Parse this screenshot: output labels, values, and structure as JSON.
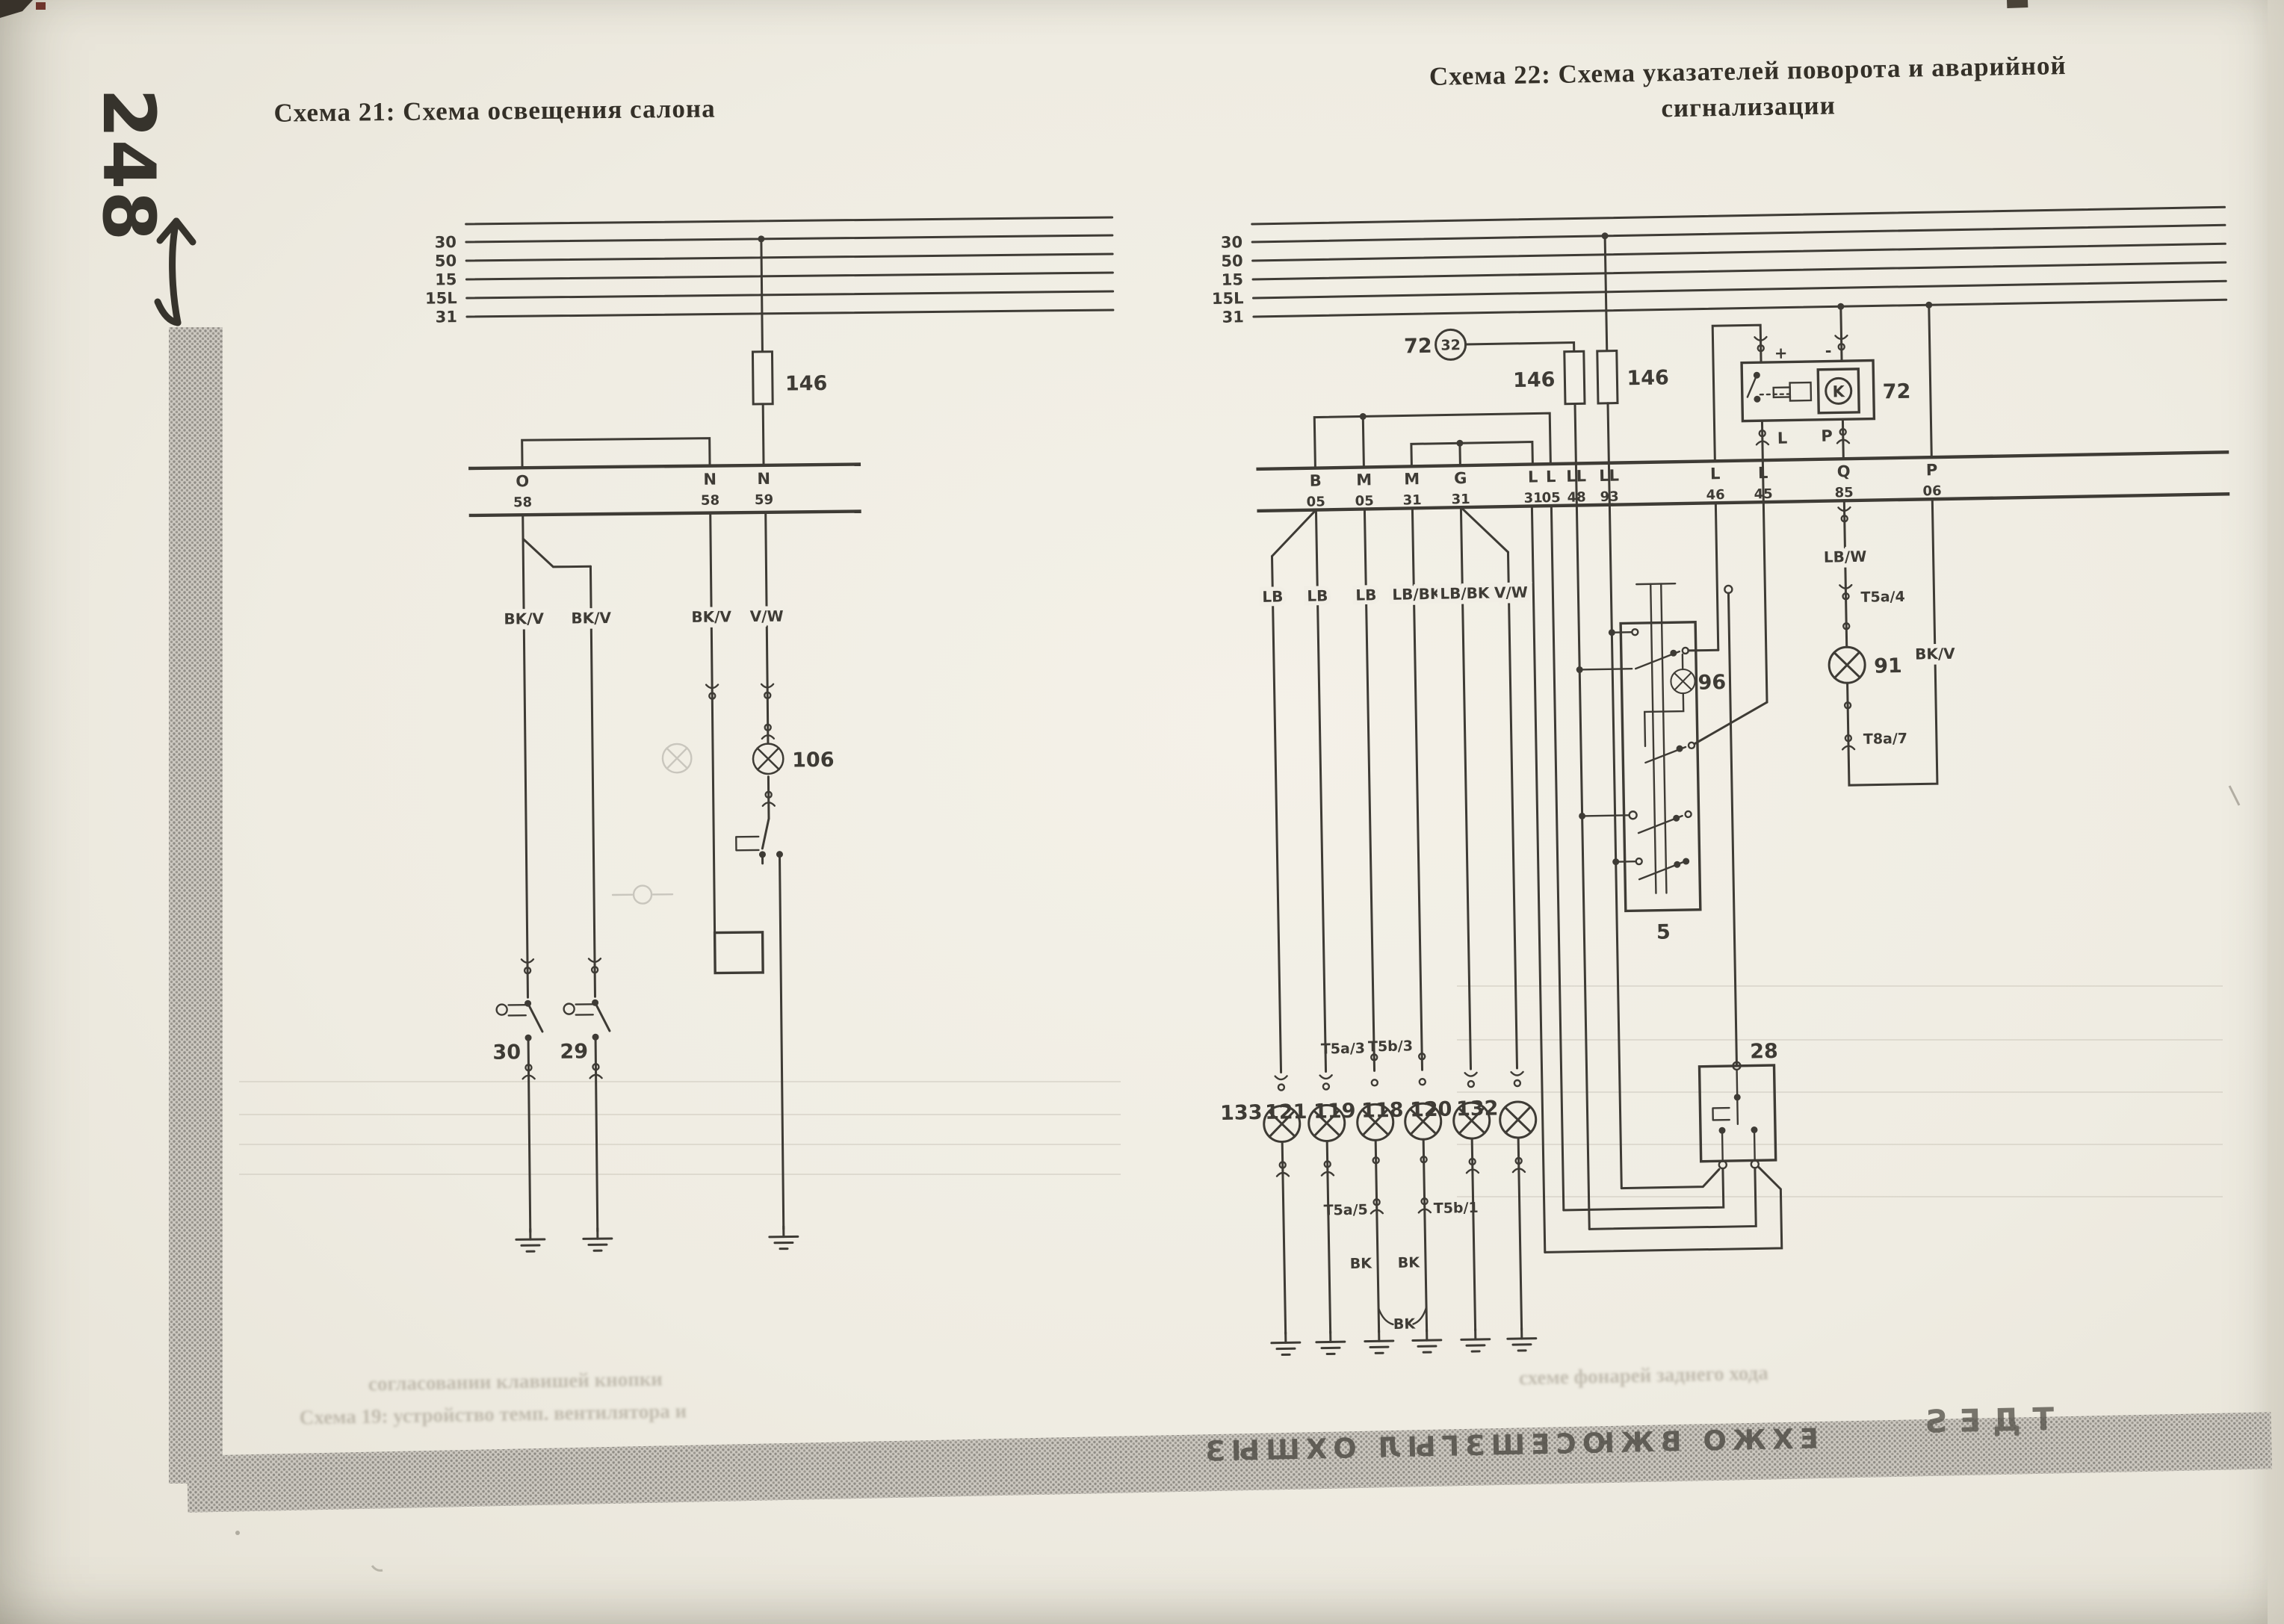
{
  "page": {
    "number": "248",
    "colors": {
      "paper": "#f1eee5",
      "ink": "#3e3b35",
      "band": "#c6c2ba",
      "accent_dark": "#36332c"
    }
  },
  "schema21": {
    "title": "Схема 21: Схема освещения салона",
    "bus_labels": [
      "30",
      "50",
      "15",
      "15L",
      "31"
    ],
    "fuse": "146",
    "terminals": [
      {
        "letter": "O",
        "number": "58"
      },
      {
        "letter": "N",
        "number": "58"
      },
      {
        "letter": "N",
        "number": "59"
      }
    ],
    "wire_labels": [
      "BK/V",
      "BK/V",
      "BK/V",
      "V/W"
    ],
    "lamp": "106",
    "switches": [
      "30",
      "29"
    ]
  },
  "schema22": {
    "title_line1": "Схема 22: Схема указателей поворота и аварийной",
    "title_line2": "сигнализации",
    "bus_labels": [
      "30",
      "50",
      "15",
      "15L",
      "31"
    ],
    "sender": {
      "label": "72",
      "circle": "32"
    },
    "fuses": [
      "146",
      "146"
    ],
    "relay": {
      "label": "72",
      "symbol": "K",
      "plus": "+",
      "minus": "-",
      "pin_l": "L",
      "pin_p": "P"
    },
    "terminals": [
      {
        "letter": "B",
        "number": "05"
      },
      {
        "letter": "M",
        "number": "05"
      },
      {
        "letter": "M",
        "number": "31"
      },
      {
        "letter": "G",
        "number": "31"
      },
      {
        "letter": "L",
        "number": "31"
      },
      {
        "letter": "L",
        "number": "05"
      },
      {
        "letter": "LL",
        "number": "48"
      },
      {
        "letter": "LL",
        "number": "93"
      },
      {
        "letter": "L",
        "number": "46"
      },
      {
        "letter": "L",
        "number": "45"
      },
      {
        "letter": "Q",
        "number": "85"
      },
      {
        "letter": "P",
        "number": "06"
      }
    ],
    "wire_labels": [
      "LB",
      "LB",
      "LB",
      "LB/BK",
      "LB/BK",
      "V/W"
    ],
    "pilot": {
      "wire_top": "LB/W",
      "conn_top": "T5a/4",
      "lamp": "91",
      "conn_bottom": "T8a/7",
      "wire_return": "BK/V"
    },
    "switch_unit": {
      "label": "5",
      "lamp": "96"
    },
    "hazard_switch": "28",
    "bulbs": [
      "133",
      "121",
      "119",
      "118",
      "120",
      "132"
    ],
    "bulb_connectors": {
      "above_left": "T5a/3",
      "above_right": "T5b/3",
      "below_left": "T5a/5",
      "below_right": "T5b/1",
      "bk_left": "BK",
      "bk_right": "BK",
      "bk_bottom": "BK"
    }
  },
  "artifacts": {
    "band_text_main": "ЕХЖО ВЖЮСЕШЗГЫЛ ОХШЫЗ",
    "band_text_right": "ТДЕS",
    "faint_text_1": "согласовании клавишей кнопки",
    "faint_text_2": "Схема 19: устройство темп. вентилятора и",
    "faint_text_3": "схеме фонарей заднего хода"
  }
}
